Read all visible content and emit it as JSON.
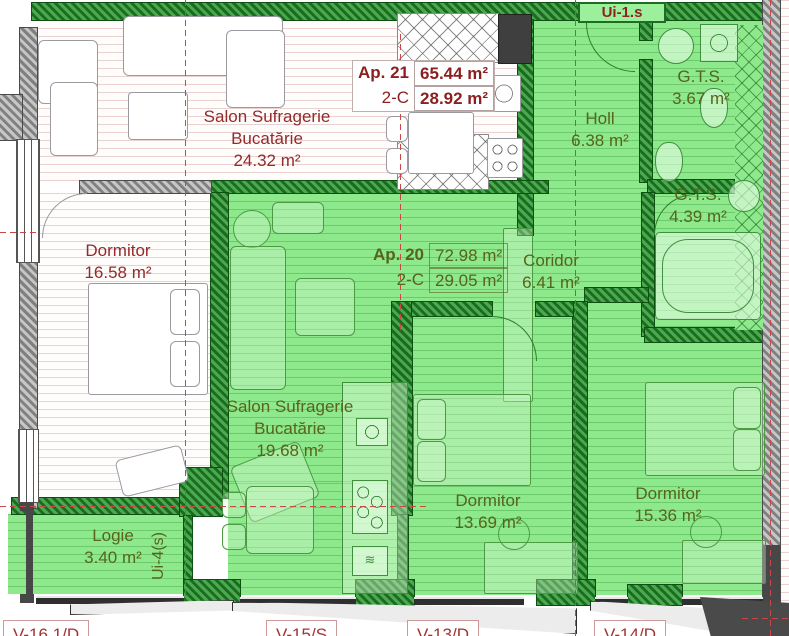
{
  "apartments": {
    "ap21": {
      "id": "Ap. 21",
      "type": "2-C",
      "area_total": "65.44 m²",
      "area_partial": "28.92 m²"
    },
    "ap20": {
      "id": "Ap. 20",
      "type": "2-C",
      "area_total": "72.98 m²",
      "area_partial": "29.05 m²"
    }
  },
  "rooms": {
    "salon21": {
      "l1": "Salon Sufragerie",
      "l2": "Bucatărie",
      "area": "24.32 m²"
    },
    "dorm21": {
      "l1": "Dormitor",
      "area": "16.58 m²"
    },
    "gts1": {
      "l1": "G.T.S.",
      "area": "3.67 m²"
    },
    "holl": {
      "l1": "Holl",
      "area": "6.38 m²"
    },
    "gts2": {
      "l1": "G.T.S.",
      "area": "4.39 m²"
    },
    "coridor": {
      "l1": "Coridor",
      "area": "6.41 m²"
    },
    "salon20": {
      "l1": "Salon Sufragerie",
      "l2": "Bucatărie",
      "area": "19.68 m²"
    },
    "dorm20a": {
      "l1": "Dormitor",
      "area": "13.69 m²"
    },
    "dorm20b": {
      "l1": "Dormitor",
      "area": "15.36 m²"
    },
    "logie": {
      "l1": "Logie",
      "area": "3.40 m²"
    }
  },
  "doors": {
    "ui1s": "Ui-1.s",
    "ui4s": "Ui-4(s)"
  },
  "windows": {
    "w1": "V-16.1/D",
    "w2": "V-15/S",
    "w3": "V-13/D",
    "w4": "V-14/D"
  },
  "colors": {
    "highlight_green": "#8de98c",
    "wall_green": "#1b6b20",
    "label_red": "#942a2a",
    "label_olive": "#57641a",
    "axis_red": "#c94747"
  }
}
